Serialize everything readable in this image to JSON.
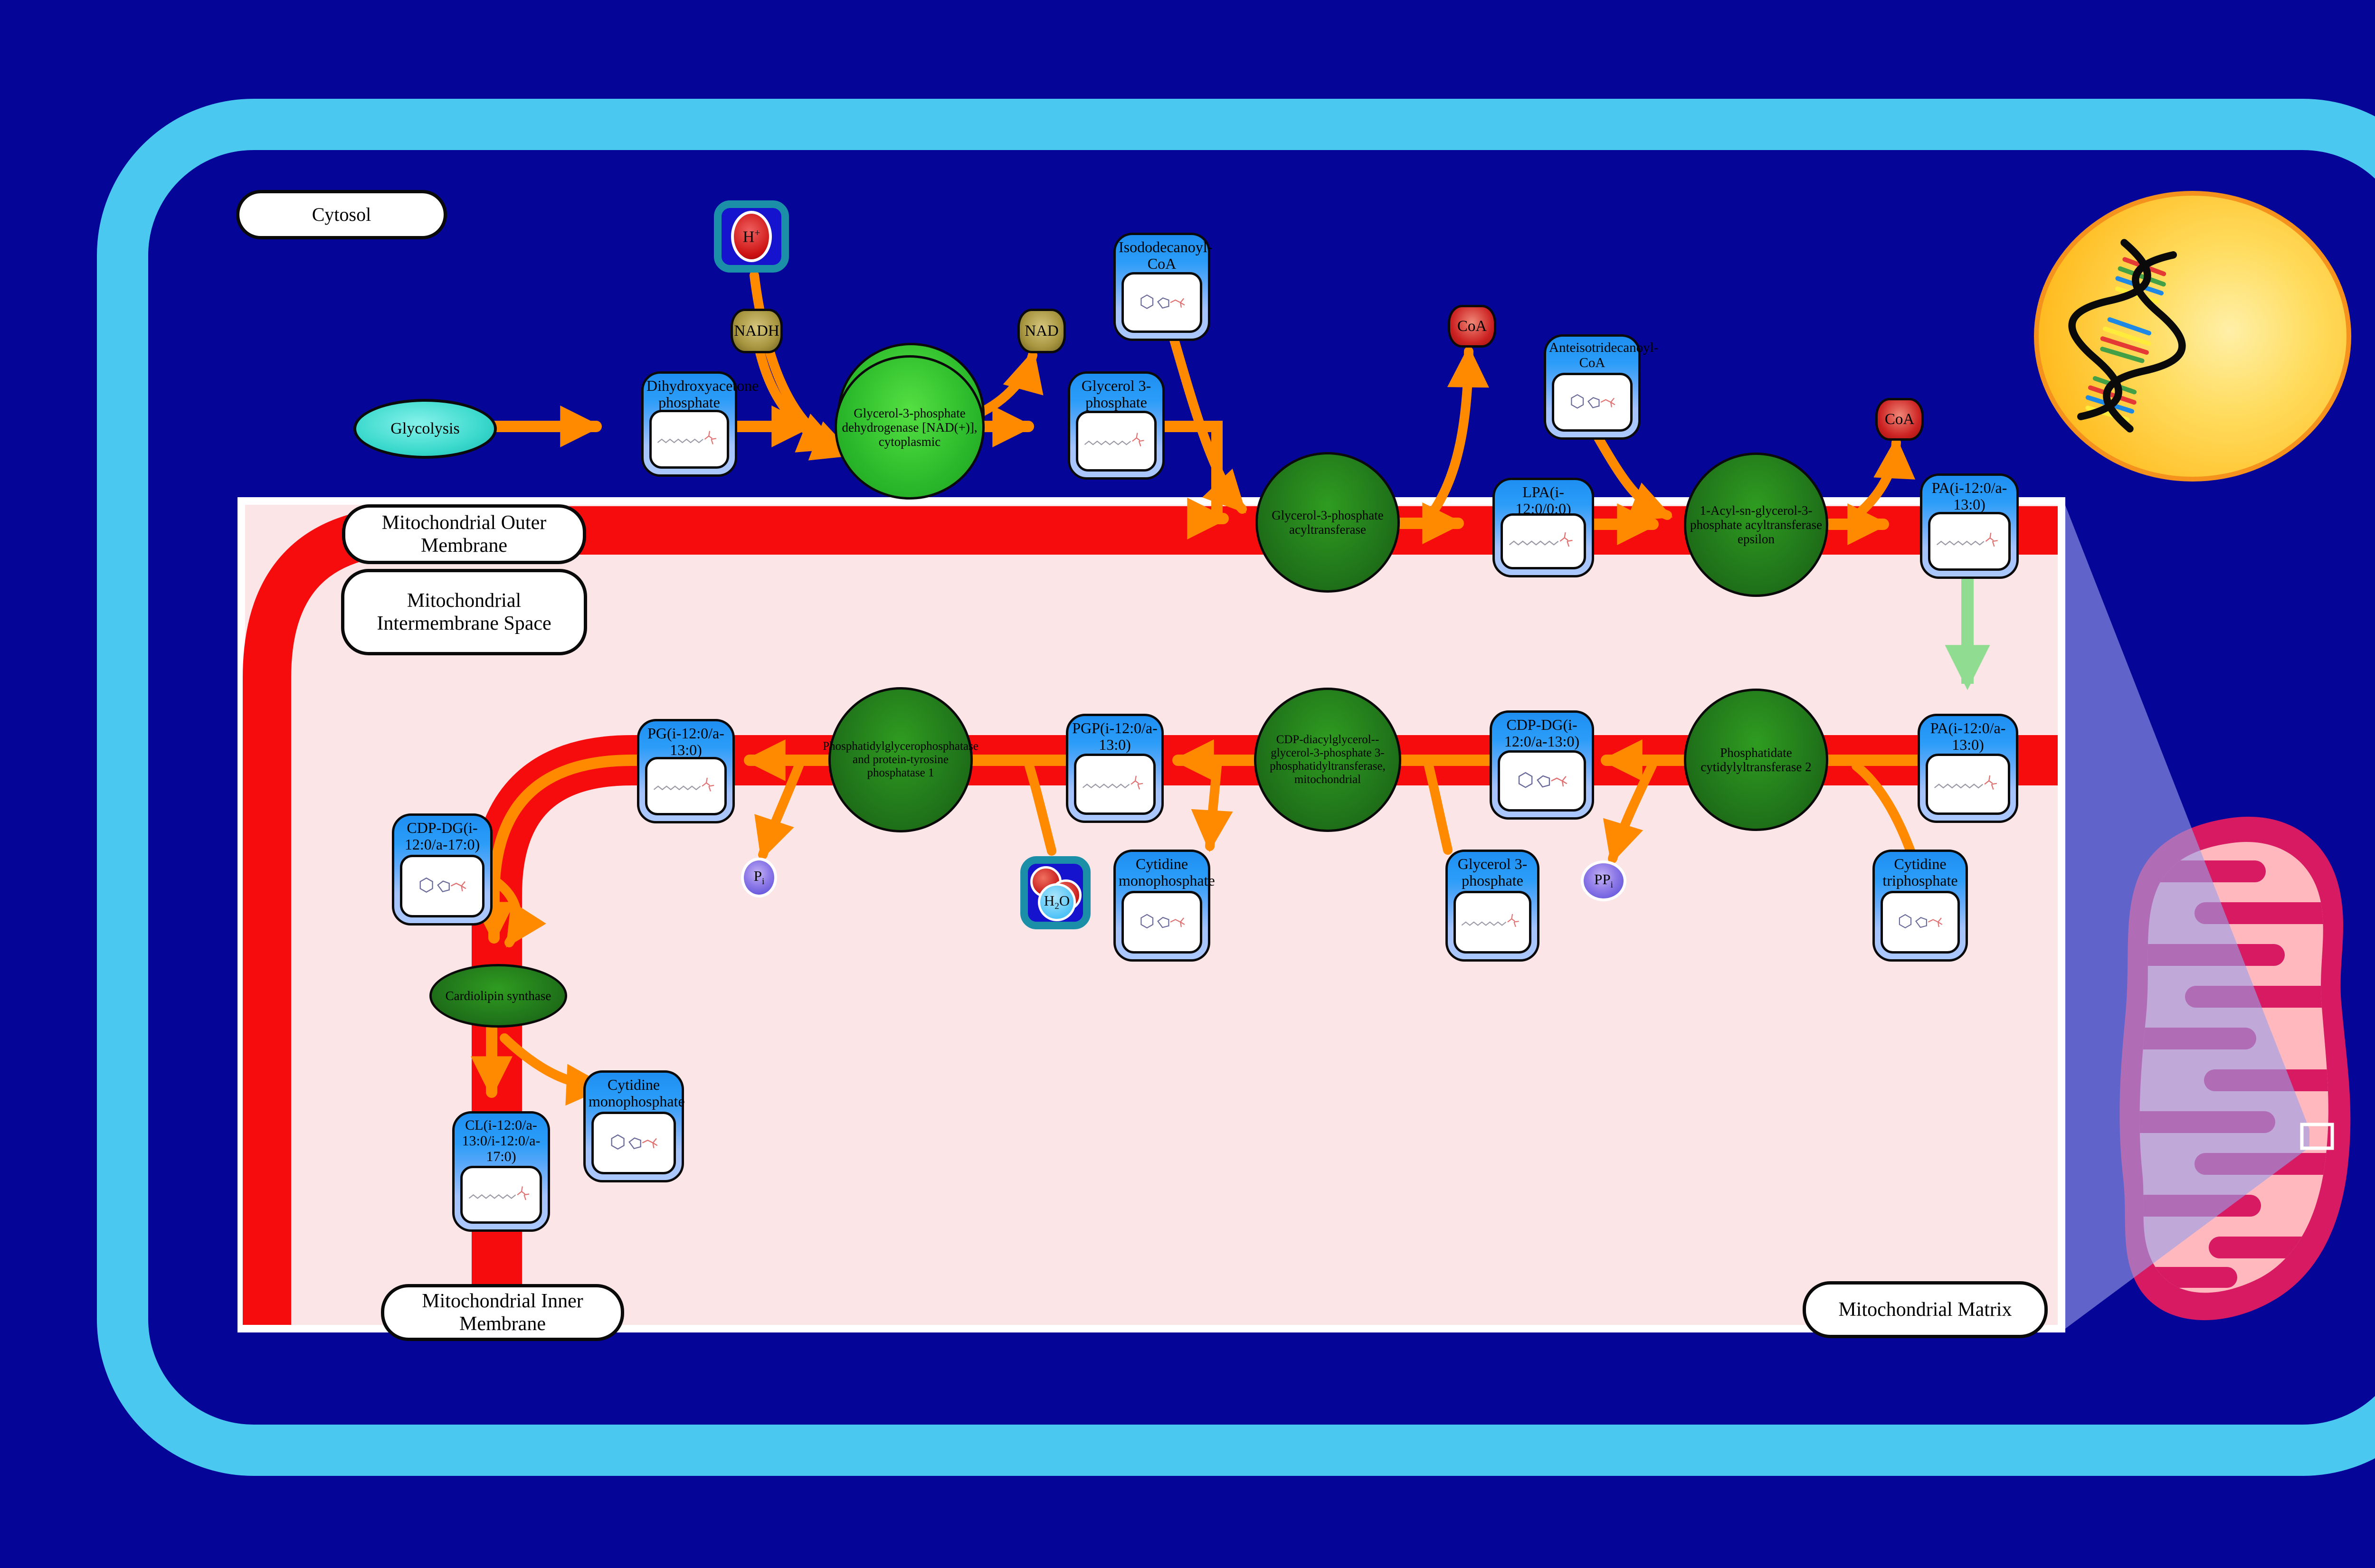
{
  "colors": {
    "background": "#050597",
    "cell_border": "#4AC8EF",
    "panel_fill": "#FBE5E6",
    "membrane_red": "#F60C0C",
    "reaction_arrow_orange": "#FF8A00",
    "transport_arrow_green": "#90DC90",
    "enzyme_green": "#20741A",
    "metabolite_header_blue": "#2B9DF8",
    "nucleus_yellow": "#FFC21E",
    "mitochondrion_crimson": "#D81A62"
  },
  "compartments": {
    "cytosol": "Cytosol",
    "outer_membrane": "Mitochondrial Outer Membrane",
    "intermembrane_space": "Mitochondrial Intermembrane Space",
    "inner_membrane": "Mitochondrial Inner Membrane",
    "matrix": "Mitochondrial Matrix"
  },
  "process": {
    "glycolysis_label": "Glycolysis"
  },
  "metabolites": [
    {
      "label": "Dihydroxyacetone phosphate"
    },
    {
      "label": "Glycerol 3-phosphate"
    },
    {
      "label": "Isododecanoyl-CoA"
    },
    {
      "label": "Anteisotridecanoyl-CoA"
    },
    {
      "label": "LPA(i-12:0/0:0)"
    },
    {
      "label": "PA(i-12:0/a-13:0)"
    },
    {
      "label": "PA(i-12:0/a-13:0)"
    },
    {
      "label": "CDP-DG(i-12:0/a-13:0)"
    },
    {
      "label": "PGP(i-12:0/a-13:0)"
    },
    {
      "label": "PG(i-12:0/a-13:0)"
    },
    {
      "label": "CDP-DG(i-12:0/a-17:0)"
    },
    {
      "label": "CL(i-12:0/a-13:0/i-12:0/a-17:0)"
    },
    {
      "label": "Cytidine monophosphate"
    },
    {
      "label": "Cytidine monophosphate"
    },
    {
      "label": "Glycerol 3-phosphate"
    },
    {
      "label": "Cytidine triphosphate"
    }
  ],
  "enzymes": [
    {
      "label": "Glycerol-3-phosphate dehydrogenase [NAD(+)], cytoplasmic"
    },
    {
      "label": "Glycerol-3-phosphate acyltransferase"
    },
    {
      "label": "1-Acyl-sn-glycerol-3-phosphate acyltransferase epsilon"
    },
    {
      "label": "Phosphatidate cytidylyltransferase 2"
    },
    {
      "label": "CDP-diacylglycerol--glycerol-3-phosphate 3-phosphatidyltransferase, mitochondrial"
    },
    {
      "label": "Phosphatidylglycerophosphatase and protein-tyrosine phosphatase 1"
    },
    {
      "label": "Cardiolipin synthase"
    }
  ],
  "cofactors": {
    "nadh": "NADH",
    "nad": "NAD",
    "coa_1": "CoA",
    "coa_2": "CoA",
    "proton": {
      "base": "H",
      "sup": "+"
    },
    "water": {
      "pre": "H",
      "sub": "2",
      "post": "O"
    },
    "phosphate": {
      "base": "P",
      "sub": "i"
    },
    "pyrophosphate": {
      "base": "PP",
      "sub": "i"
    }
  }
}
